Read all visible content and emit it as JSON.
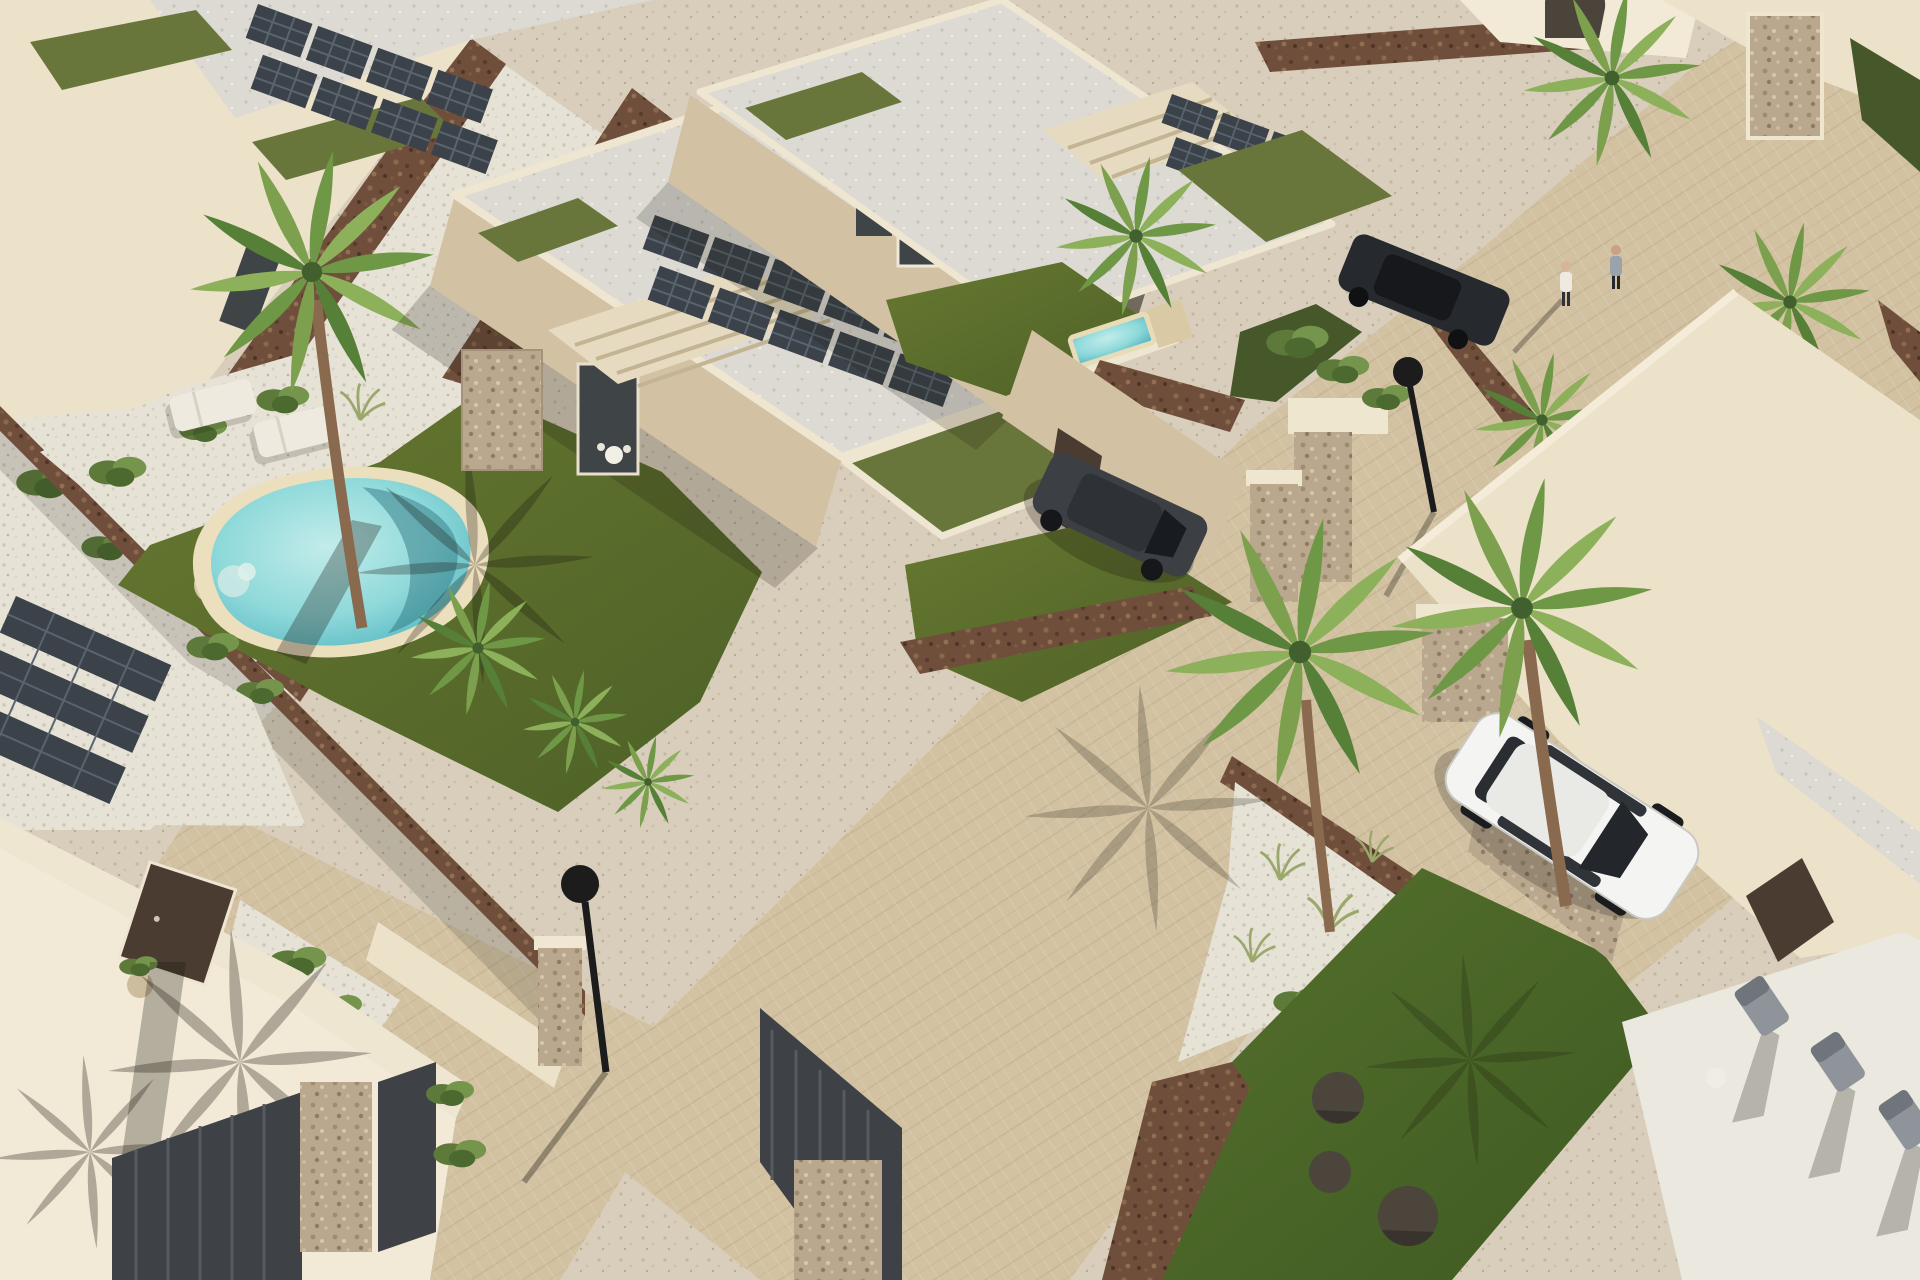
{
  "scene": {
    "title": "Aerial 3D architectural render of a modern villa development",
    "description": "Bird's-eye 3D rendering of a new-build Mediterranean villa community at midday. Flat-roofed cream villas with gravel roofs, rooftop solar panel arrays and green-roof patches are separated by rubble-stone brown walls, sand-coloured paver lanes and white gravel landscaping. The central villa has a private garden with a kidney-shaped turquoise pool, two white sun loungers and a tall palm tree. A white SUV is parked on a driveway at the right, a dark grey car waits behind the middle villa, and a second dark car is parked near the top-right lane where two pedestrians walk. A bright green lawn with dark poufs and a white chill-out terrace with grey deck chairs fills the bottom-right parcel.",
    "style": "photorealistic CGI, strong sunlight from the upper right, long shadows to the lower left",
    "time_of_day": "midday"
  },
  "colors": {
    "gravel_tan": "#d8ceba",
    "gravel_white": "#e7e2d6",
    "paver_street": "#d2c2a2",
    "wall_cream": "#ece1c9",
    "wall_cream_lit": "#f2e9d6",
    "wall_tan_face": "#d2c1a2",
    "roof_white": "#dddad3",
    "green_roof": "#68763b",
    "lawn": "#5a6d31",
    "lawn_bright": "#4f662a",
    "lawn_dark": "#46572a",
    "mulch_brown": "#6f4f3b",
    "stone_clad": "#b9a88e",
    "pool_rim": "#ecdfbd",
    "pool_water": "#7fd2d6",
    "panel_dark": "#3b424a",
    "palm_green": "#6e9746",
    "palm_trunk": "#8a6a4e",
    "car_white": "#f4f4f2",
    "car_dark": "#26292e",
    "car_gray": "#3c4044",
    "door_dark": "#4a3c30",
    "glass_dark": "#3f4547",
    "gate_dark": "#3e4246",
    "lamp_black": "#1c1c1c",
    "pouf_dark": "#4b453c",
    "chair_gray": "#8f949a",
    "lounger_white": "#efeadf"
  },
  "inventory": {
    "villas": 6,
    "solar_panel_arrays": 4,
    "pools": {
      "main_pool": "kidney-shaped pool with sand-coloured surround in central garden",
      "plunge_pool": "small rectangular plunge pool on the patio of the top-centre villa"
    },
    "sun_loungers_white": 2,
    "deck_chairs_gray": 3,
    "lawn_poufs_dark": 3,
    "vehicles": {
      "white_suv": "white SUV parked on the right-hand driveway",
      "dark_car_lane": "dark car parked on the upper-right lane",
      "gray_car": "dark grey car parked behind the middle villa"
    },
    "pedestrians": 2,
    "street_lamps": 2,
    "palm_trees": 10,
    "stone_pillars": 8,
    "gates_dark": 3
  }
}
